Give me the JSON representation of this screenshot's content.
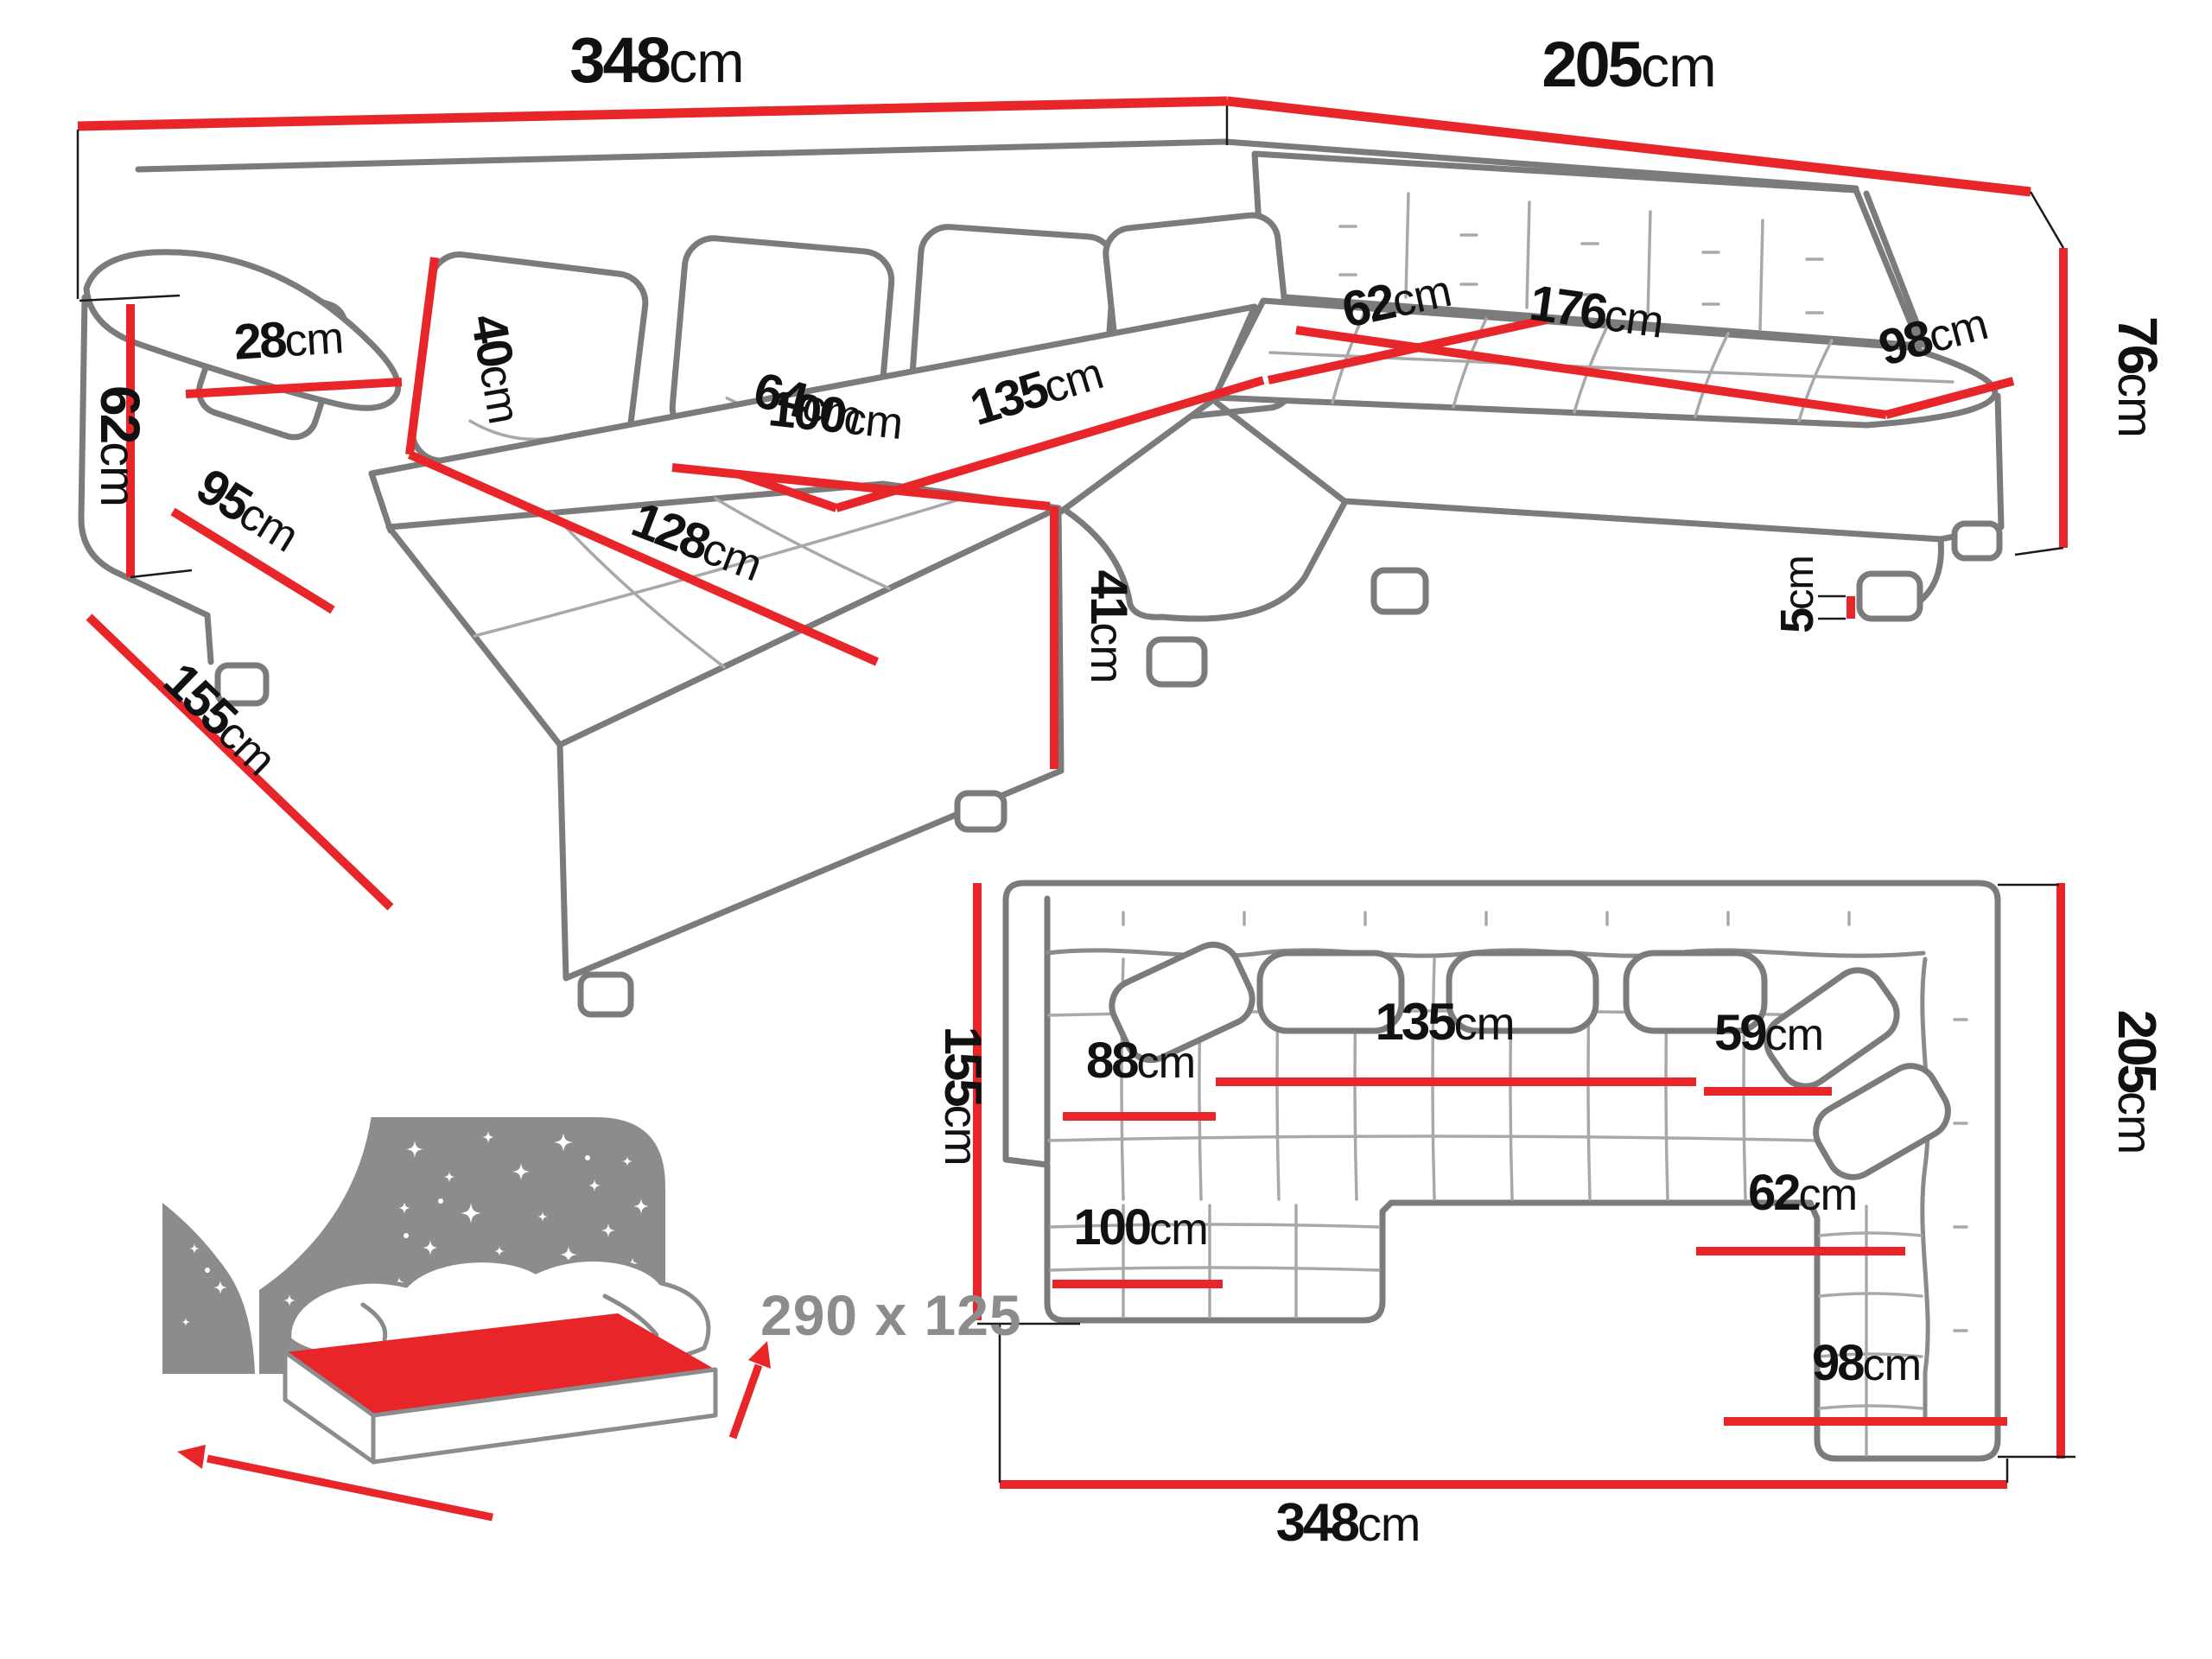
{
  "diagram_title": "corner-sofa-dimensions",
  "colors": {
    "dimension_line": "#e8262a",
    "sofa_outline": "#7b7b7b",
    "detail_line": "#a8a8a8",
    "label_text": "#111111",
    "sleeping_text": "#8c8c8c",
    "bed_headboard": "#8c8c8c",
    "bed_mattress": "#e8262a"
  },
  "perspective": {
    "d348": {
      "num": "348",
      "unit": "cm"
    },
    "d205": {
      "num": "205",
      "unit": "cm"
    },
    "d76": {
      "num": "76",
      "unit": "cm"
    },
    "d62h": {
      "num": "62",
      "unit": "cm"
    },
    "d95": {
      "num": "95",
      "unit": "cm"
    },
    "d155": {
      "num": "155",
      "unit": "cm"
    },
    "d28": {
      "num": "28",
      "unit": "cm"
    },
    "d40": {
      "num": "40",
      "unit": "cm"
    },
    "d64": {
      "num": "64",
      "unit": "cm"
    },
    "d135": {
      "num": "135",
      "unit": "cm"
    },
    "d128": {
      "num": "128",
      "unit": "cm"
    },
    "d100": {
      "num": "100",
      "unit": "cm"
    },
    "d41": {
      "num": "41",
      "unit": "cm"
    },
    "d62d": {
      "num": "62",
      "unit": "cm"
    },
    "d176": {
      "num": "176",
      "unit": "cm"
    },
    "d98": {
      "num": "98",
      "unit": "cm"
    },
    "d5": {
      "num": "5",
      "unit": "cm"
    }
  },
  "plan": {
    "d155": {
      "num": "155",
      "unit": "cm"
    },
    "d88": {
      "num": "88",
      "unit": "cm"
    },
    "d135": {
      "num": "135",
      "unit": "cm"
    },
    "d59": {
      "num": "59",
      "unit": "cm"
    },
    "d62": {
      "num": "62",
      "unit": "cm"
    },
    "d100": {
      "num": "100",
      "unit": "cm"
    },
    "d98": {
      "num": "98",
      "unit": "cm"
    },
    "d205": {
      "num": "205",
      "unit": "cm"
    },
    "d348": {
      "num": "348",
      "unit": "cm"
    }
  },
  "sleeping_area": {
    "text": "290 x 125"
  }
}
